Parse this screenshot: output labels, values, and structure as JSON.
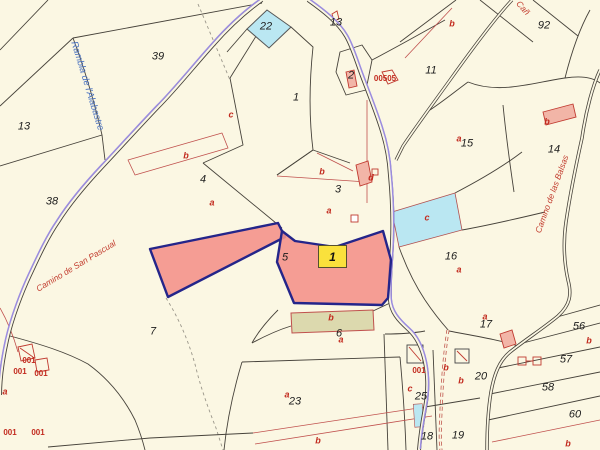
{
  "map": {
    "selected_parcel": {
      "label": "1"
    },
    "colors": {
      "background": "#FBF7E3",
      "boundary_line": "#46423A",
      "subparcel_line": "#C0504D",
      "road_purple": "#9B8CE0",
      "road_name_blue": "#4A72C0",
      "road_name_red": "#C23C2E",
      "highlight_fill": "#F4928B",
      "highlight_border": "#24258A",
      "water_cyan": "#BAE7F2",
      "selected_label_yellow": "#FAE13C",
      "khaki_fill": "#DCD9AE",
      "building_fill": "#F2B5A7"
    },
    "labels": [
      {
        "t": "39",
        "x": 158,
        "y": 57,
        "k": "p"
      },
      {
        "t": "13",
        "x": 24,
        "y": 127,
        "k": "p"
      },
      {
        "t": "38",
        "x": 52,
        "y": 202,
        "k": "p"
      },
      {
        "t": "4",
        "x": 203,
        "y": 180,
        "k": "p"
      },
      {
        "t": "1",
        "x": 296,
        "y": 98,
        "k": "p"
      },
      {
        "t": "2",
        "x": 351,
        "y": 76,
        "k": "p"
      },
      {
        "t": "22",
        "x": 266,
        "y": 27,
        "k": "p"
      },
      {
        "t": "13",
        "x": 336,
        "y": 23,
        "k": "p"
      },
      {
        "t": "11",
        "x": 431,
        "y": 71,
        "k": "p"
      },
      {
        "t": "92",
        "x": 544,
        "y": 26,
        "k": "p"
      },
      {
        "t": "15",
        "x": 467,
        "y": 144,
        "k": "p"
      },
      {
        "t": "14",
        "x": 554,
        "y": 150,
        "k": "p"
      },
      {
        "t": "3",
        "x": 338,
        "y": 190,
        "k": "p"
      },
      {
        "t": "16",
        "x": 451,
        "y": 257,
        "k": "p"
      },
      {
        "t": "5",
        "x": 285,
        "y": 258,
        "k": "p"
      },
      {
        "t": "7",
        "x": 153,
        "y": 332,
        "k": "p"
      },
      {
        "t": "23",
        "x": 295,
        "y": 402,
        "k": "p"
      },
      {
        "t": "6",
        "x": 339,
        "y": 334,
        "k": "p"
      },
      {
        "t": "17",
        "x": 486,
        "y": 325,
        "k": "p"
      },
      {
        "t": "20",
        "x": 481,
        "y": 377,
        "k": "p"
      },
      {
        "t": "25",
        "x": 421,
        "y": 397,
        "k": "p"
      },
      {
        "t": "18",
        "x": 427,
        "y": 437,
        "k": "p"
      },
      {
        "t": "19",
        "x": 458,
        "y": 436,
        "k": "p"
      },
      {
        "t": "56",
        "x": 579,
        "y": 327,
        "k": "p"
      },
      {
        "t": "57",
        "x": 566,
        "y": 360,
        "k": "p"
      },
      {
        "t": "58",
        "x": 548,
        "y": 388,
        "k": "p"
      },
      {
        "t": "60",
        "x": 575,
        "y": 415,
        "k": "p"
      },
      {
        "t": "a",
        "x": 212,
        "y": 203,
        "k": "s"
      },
      {
        "t": "b",
        "x": 186,
        "y": 156,
        "k": "s"
      },
      {
        "t": "c",
        "x": 231,
        "y": 115,
        "k": "s"
      },
      {
        "t": "b",
        "x": 322,
        "y": 172,
        "k": "s"
      },
      {
        "t": "a",
        "x": 329,
        "y": 211,
        "k": "s"
      },
      {
        "t": "d",
        "x": 371,
        "y": 178,
        "k": "s"
      },
      {
        "t": "b",
        "x": 452,
        "y": 24,
        "k": "s"
      },
      {
        "t": "a",
        "x": 459,
        "y": 139,
        "k": "s"
      },
      {
        "t": "c",
        "x": 427,
        "y": 218,
        "k": "s"
      },
      {
        "t": "a",
        "x": 459,
        "y": 270,
        "k": "s"
      },
      {
        "t": "b",
        "x": 547,
        "y": 122,
        "k": "s"
      },
      {
        "t": "a",
        "x": 287,
        "y": 395,
        "k": "s"
      },
      {
        "t": "b",
        "x": 331,
        "y": 318,
        "k": "s"
      },
      {
        "t": "a",
        "x": 341,
        "y": 340,
        "k": "s"
      },
      {
        "t": "a",
        "x": 485,
        "y": 317,
        "k": "s"
      },
      {
        "t": "b",
        "x": 446,
        "y": 368,
        "k": "s"
      },
      {
        "t": "b",
        "x": 461,
        "y": 381,
        "k": "s"
      },
      {
        "t": "c",
        "x": 410,
        "y": 389,
        "k": "s"
      },
      {
        "t": "a",
        "x": 5,
        "y": 392,
        "k": "s"
      },
      {
        "t": "b",
        "x": 318,
        "y": 441,
        "k": "s"
      },
      {
        "t": "b",
        "x": 589,
        "y": 341,
        "k": "s"
      },
      {
        "t": "b",
        "x": 568,
        "y": 444,
        "k": "s"
      },
      {
        "t": "001",
        "x": 29,
        "y": 361,
        "k": "b"
      },
      {
        "t": "001",
        "x": 20,
        "y": 372,
        "k": "b"
      },
      {
        "t": "001",
        "x": 41,
        "y": 374,
        "k": "b"
      },
      {
        "t": "001",
        "x": 419,
        "y": 371,
        "k": "b"
      },
      {
        "t": "00505",
        "x": 385,
        "y": 79,
        "k": "b"
      },
      {
        "t": "001",
        "x": 10,
        "y": 433,
        "k": "b"
      },
      {
        "t": "001",
        "x": 38,
        "y": 433,
        "k": "b"
      },
      {
        "t": "Rambla de l'Alabastre",
        "x": 87,
        "y": 86,
        "r": 73,
        "k": "rb"
      },
      {
        "t": "Camino de San Pascual",
        "x": 76,
        "y": 266,
        "r": -31,
        "k": "rr"
      },
      {
        "t": "Camino de las Balsas",
        "x": 552,
        "y": 194,
        "r": -70,
        "k": "rr"
      },
      {
        "t": "Cañ",
        "x": 523,
        "y": 8,
        "r": 48,
        "k": "rr"
      }
    ]
  }
}
